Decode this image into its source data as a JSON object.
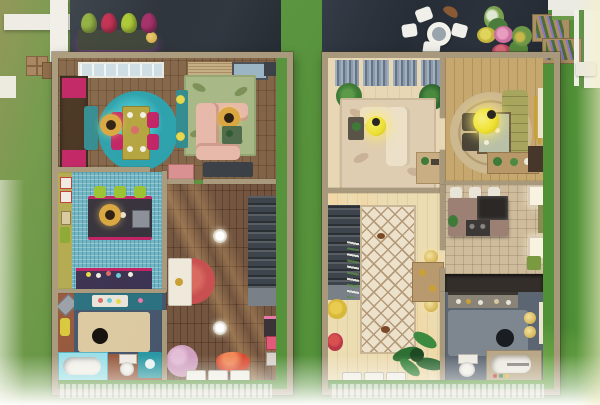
{
  "meta": {
    "app": "life-simulation game build mode",
    "view": "top-down dollhouse floor plan of two adjacent rowhouse units separated by a grass strip",
    "units": 2
  },
  "palette": {
    "wallTan": "#a8997c",
    "deckNavy": "#2b323c",
    "woodFloorL": "#7b5b3d",
    "woodDarkHall": "#6b4a33",
    "mosaicBlue": "#6db4c4",
    "oliveWall": "#b2a94e",
    "wardrobeBrown": "#44301e",
    "magenta": "#c02063",
    "tealRug": "#28a0ac",
    "tableOlive": "#b3a43e",
    "rattan": "#d9a63f",
    "rugGreen": "#a6b785",
    "sofaPink": "#e6b8aa",
    "tealConsole": "#2f8a8f",
    "coffeeGreen": "#4f6a4a",
    "islandDark": "#34303a",
    "stoolGreen": "#98c22f",
    "counterPurple": "#3a3050",
    "bathNavy": "#46566c",
    "terracotta": "#96573c",
    "vanityTeal": "#2a7080",
    "rugCream": "#dcc9a2",
    "tubCyan": "#9adfe8",
    "beanbagRed": "#d84a30",
    "blossomPink": "#cfa0bf",
    "coralRug": "#c85050",
    "consoleWhite": "#efe9dc",
    "stairDark": "#3e444b",
    "floorCreamR": "#e7d7b5",
    "floorTanR": "#c6a76e",
    "tileBeigeR": "#cfbc9d",
    "hallFloorR": "#ecdcb2",
    "rugBeigeR": "#dfcdb2",
    "sofaCream": "#ece0c8",
    "pendantYellow": "#ecdf33",
    "oliveSofa": "#a8a55e",
    "roundRugTan": "#cdb990",
    "islandMauve": "#9c8074",
    "applianceDark": "#2c2826",
    "runnerCream": "#ece1ca",
    "lattice": "#b49a78",
    "slateFloor": "#5c6673",
    "rugGray": "#7e8690",
    "tubTan": "#b8a888",
    "plantGreen": "#2e7034",
    "gold": "#c9a035",
    "blindGray": "#8e9aa8",
    "fenceWhite": "#f0efe8",
    "lavender": "#8a76c8",
    "eggGreen": "#8fae3e",
    "eggRed": "#c12a50",
    "eggLime": "#aac832",
    "eggMagenta": "#a32a68"
  },
  "scene": {
    "surroundings": {
      "grass": "lawn surrounding both units",
      "neighbor_porch": "white porch beams with wooden crates at top left",
      "rear_decks": "dark navy wood decks along the top of both units",
      "front_porch": "white railing fading out along the bottom edge",
      "right_garden": "white fence with lavender planter boxes and bench at top right"
    },
    "left_unit": {
      "deck_objects": [
        "green egg chair",
        "red egg chair",
        "lime egg chair",
        "magenta egg chair",
        "dark planter bench with round lamp"
      ],
      "dining_room": [
        "window band",
        "dark wardrobe with magenta panels",
        "teal bench",
        "round teal rug",
        "olive dining table with place settings",
        "four magenta dining chairs",
        "rattan pendant lamp"
      ],
      "living_room": [
        "louvered door",
        "window",
        "green floral rug",
        "pink sectional sofa",
        "rattan pendant lamp",
        "green coffee table",
        "teal console with yellow flowers",
        "dark media unit",
        "pink dresser"
      ],
      "kitchen": [
        "chartreuse accent wall with artwork",
        "blue mosaic tile floor",
        "dark island with magenta trim",
        "three green bar stools",
        "rattan pendant lamp",
        "dark purple back counter"
      ],
      "bathroom": [
        "teal vanity counter with tray",
        "cream bath mat with dark drain circle",
        "bathtub with cyan surround",
        "toilet",
        "teal sink cabinet",
        "terracotta floor band"
      ],
      "entry_hall": [
        "dark plank floor",
        "staircase",
        "white console table",
        "coral round rug",
        "two round ceiling lamps",
        "cherry-blossom shrub",
        "red bean bag",
        "wall posters",
        "white door mats"
      ]
    },
    "right_unit": {
      "deck_objects": [
        "white bistro table",
        "four white chairs",
        "canoe decor",
        "mixed flower planters"
      ],
      "living_room": [
        "vertical blinds band",
        "two potted plants",
        "beige floral rug",
        "cream sectional sofa",
        "yellow pendant lamp",
        "dark plant stand",
        "writing desk"
      ],
      "dining_nook": [
        "round ringed rug",
        "glass dining table",
        "two dark chairs",
        "olive tufted banquette",
        "yellow globe pendant",
        "gold wall art",
        "buffet with plants",
        "dark tall cabinet"
      ],
      "kitchen": [
        "beige tile floor",
        "mauve island with dark appliance and stove",
        "three white bar stools",
        "two bright windows",
        "green floor mat",
        "dark rear divider wall"
      ],
      "entry_hall": [
        "light plank floor",
        "staircase",
        "cream trellis runner rug",
        "yellow flowers",
        "red roses",
        "gold wall sconces",
        "wood console",
        "large potted plant",
        "white door mats"
      ],
      "bathroom": [
        "vanity counter with toiletries",
        "gray bath mat with dark drain circle",
        "paneled bathtub",
        "toilet",
        "gold towel rings",
        "bright window"
      ]
    }
  }
}
